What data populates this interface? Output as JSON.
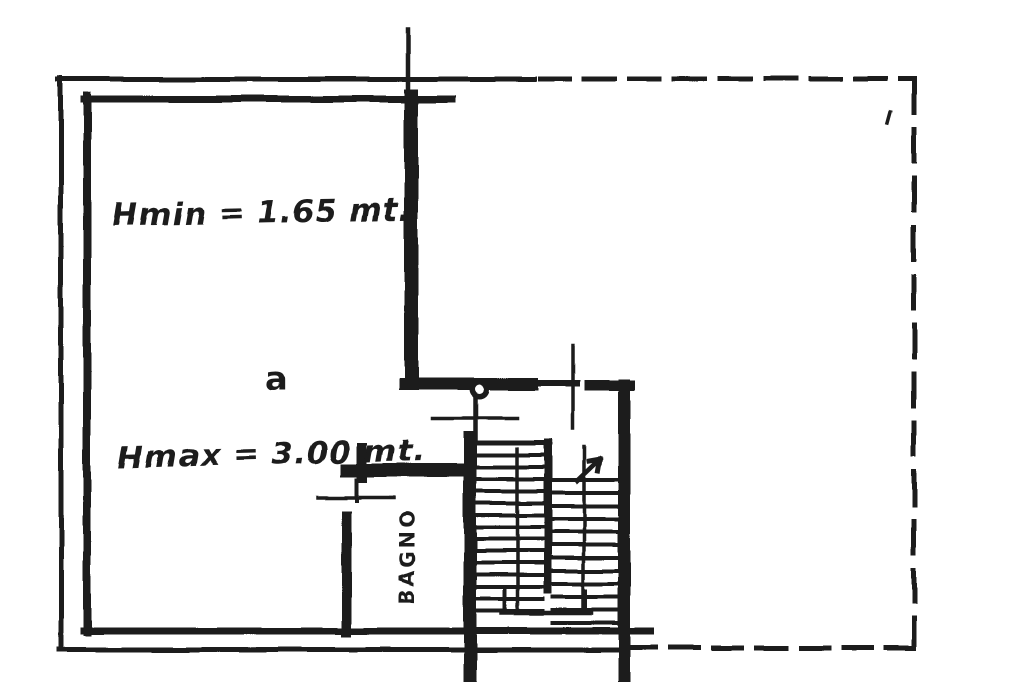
{
  "labels": {
    "hmin": "Hmin = 1.65 mt.",
    "hmax": "Hmax = 3.00 mt.",
    "room": "a",
    "bagno": "BAGNO"
  },
  "colors": {
    "ink": "#1c1c1c",
    "paper": "#ffffff"
  }
}
